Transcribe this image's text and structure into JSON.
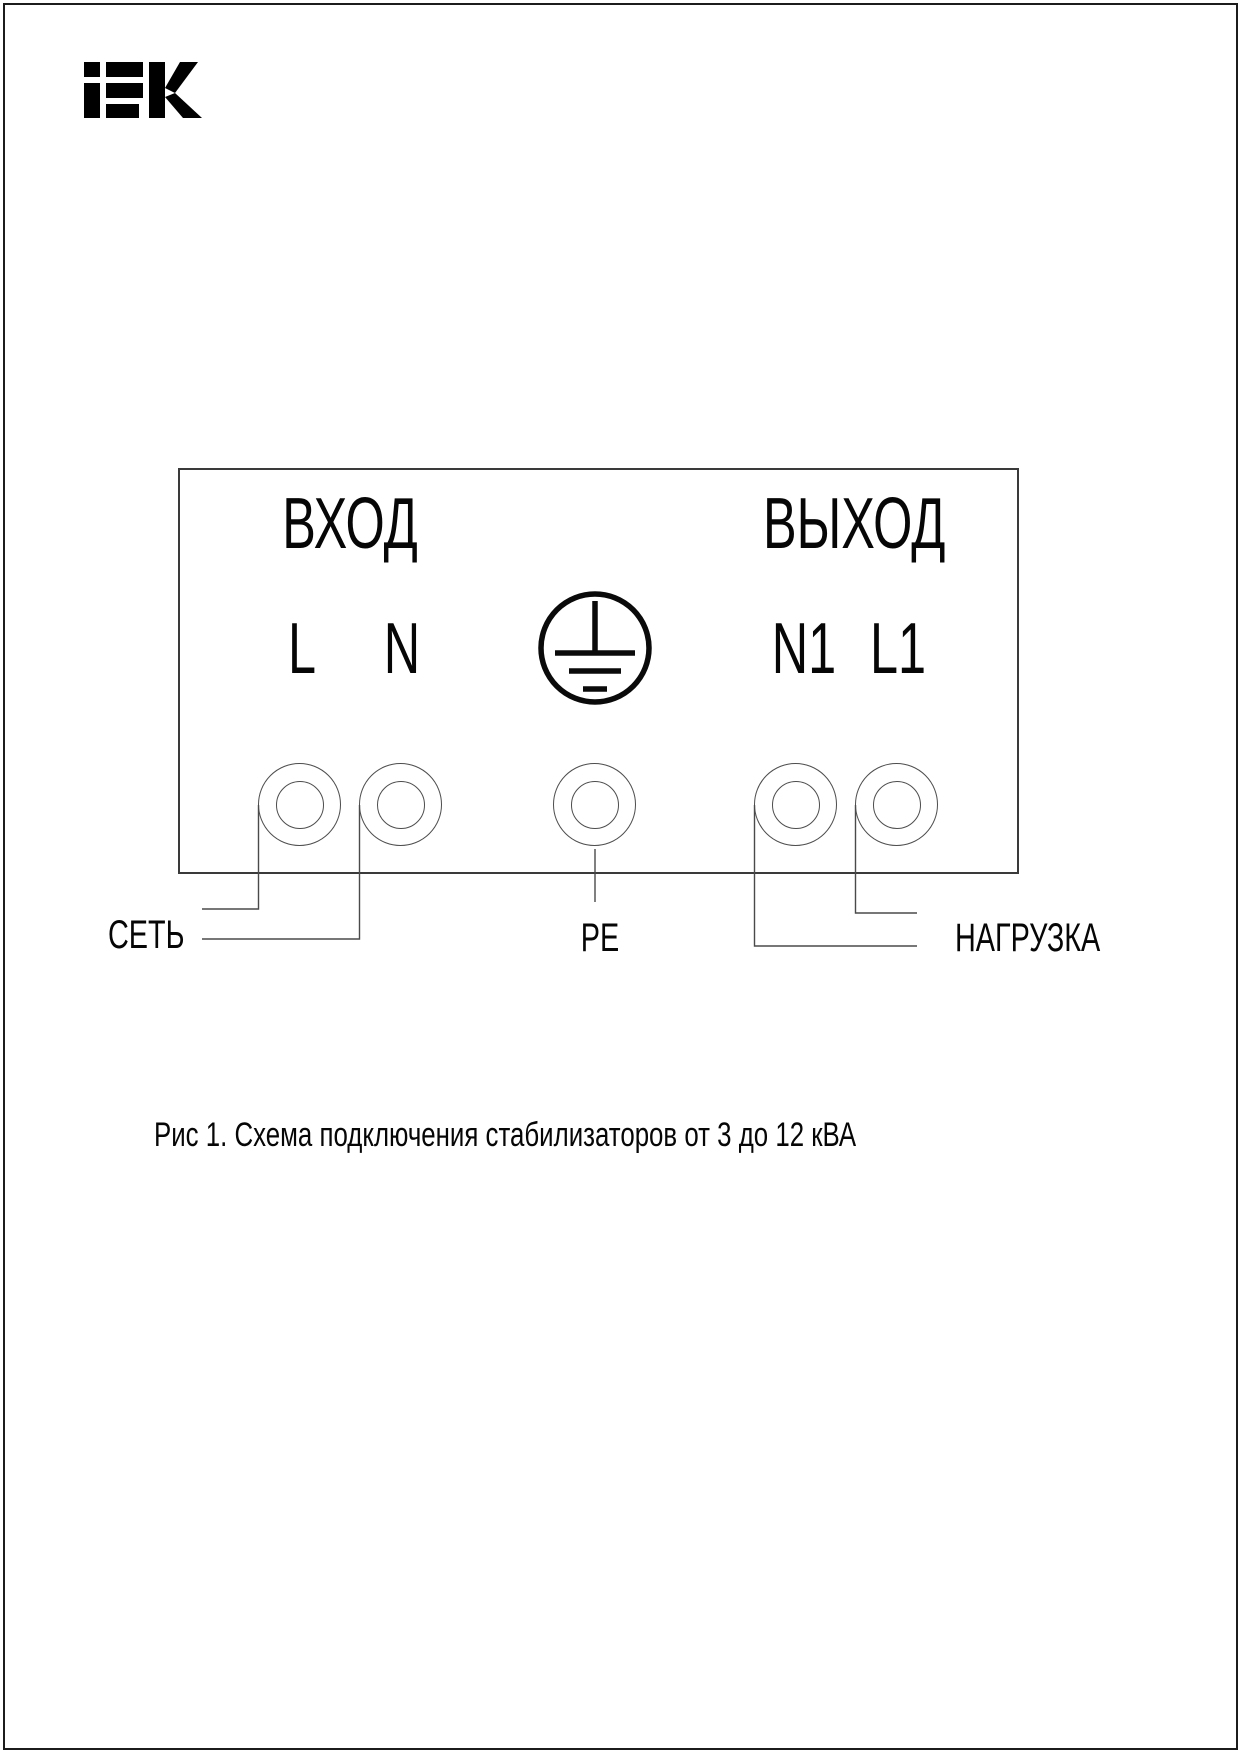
{
  "page": {
    "brand": "iEK",
    "caption": "Рис 1. Схема подключения стабилизаторов от 3 до 12 кВА"
  },
  "diagram": {
    "input": {
      "title": "ВХОД",
      "terminals": [
        "L",
        "N"
      ]
    },
    "output": {
      "title": "ВЫХОД",
      "terminals": [
        "N1",
        "L1"
      ]
    },
    "earth_icon": "protective-earth-icon",
    "labels": {
      "mains": "СЕТЬ",
      "pe": "PE",
      "load": "НАГРУЗКА"
    },
    "colors": {
      "ink": "#060606",
      "line": "#4a4a4a"
    }
  }
}
